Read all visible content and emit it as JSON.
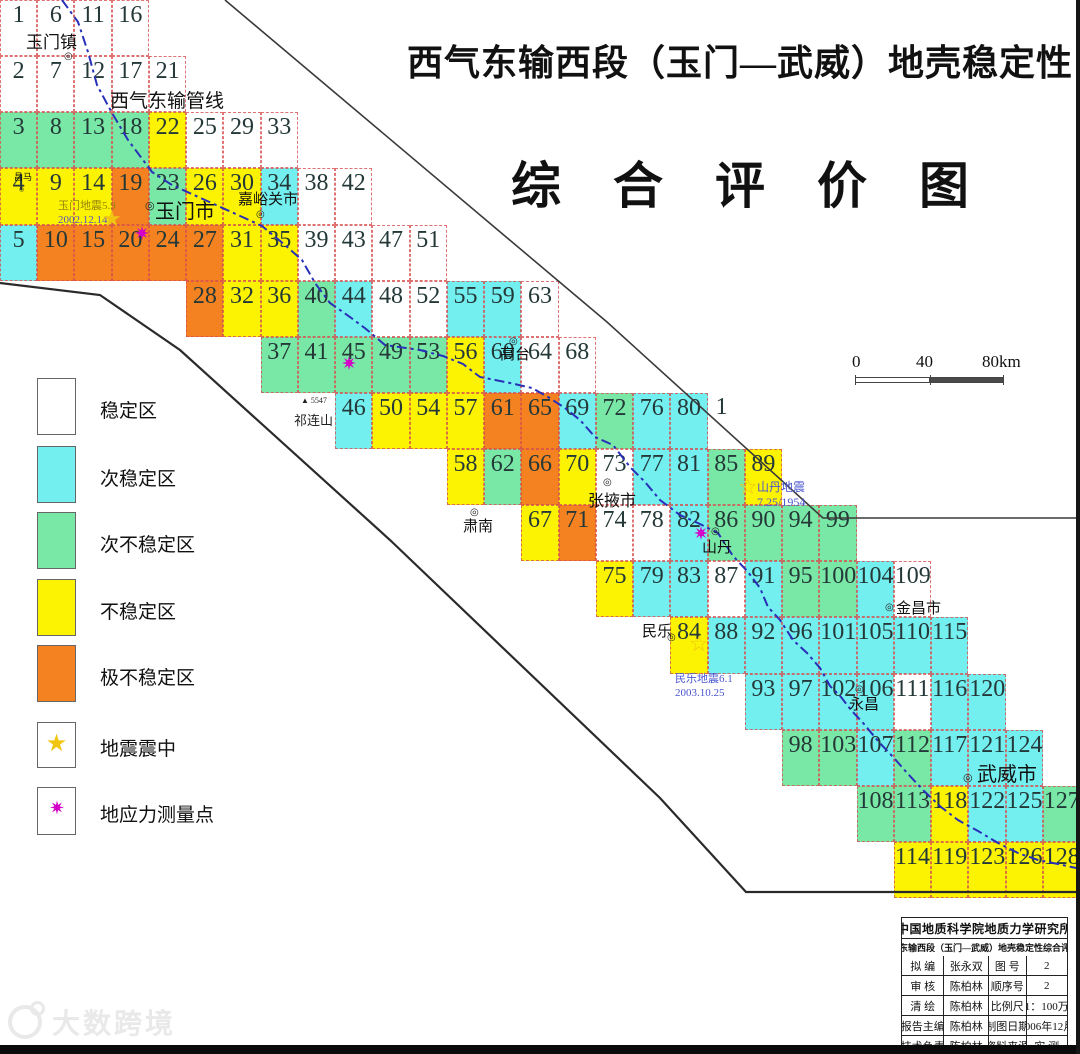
{
  "title": "西气东输西段（玉门—武威）地壳稳定性",
  "subtitle": "综合评价图",
  "map": {
    "colors": {
      "w": "#ffffff",
      "c": "#74eff0",
      "g": "#79e8a6",
      "y": "#fcf303",
      "o": "#f58220"
    },
    "pipeline_label": {
      "text": "西气东输管线",
      "x": 110,
      "y": 86,
      "fs": 19
    },
    "mountain": {
      "peak": "▲",
      "elev": "5547",
      "name": "祁连山",
      "px": 301,
      "py": 396,
      "nx": 294,
      "ny": 410
    },
    "cells": [
      [
        "1",
        0,
        0,
        "w"
      ],
      [
        "2",
        0,
        1,
        "w"
      ],
      [
        "3",
        0,
        2,
        "g"
      ],
      [
        "4",
        0,
        3,
        "y"
      ],
      [
        "5",
        0,
        4,
        "c"
      ],
      [
        "6",
        1,
        0,
        "w"
      ],
      [
        "7",
        1,
        1,
        "w"
      ],
      [
        "8",
        1,
        2,
        "g"
      ],
      [
        "9",
        1,
        3,
        "y"
      ],
      [
        "10",
        1,
        4,
        "o"
      ],
      [
        "11",
        2,
        0,
        "w"
      ],
      [
        "12",
        2,
        1,
        "w"
      ],
      [
        "13",
        2,
        2,
        "g"
      ],
      [
        "14",
        2,
        3,
        "y"
      ],
      [
        "15",
        2,
        4,
        "o"
      ],
      [
        "16",
        3,
        0,
        "w"
      ],
      [
        "17",
        3,
        1,
        "w"
      ],
      [
        "18",
        3,
        2,
        "g"
      ],
      [
        "19",
        3,
        3,
        "o"
      ],
      [
        "20",
        3,
        4,
        "o"
      ],
      [
        "21",
        4,
        1,
        "w"
      ],
      [
        "22",
        4,
        2,
        "y"
      ],
      [
        "23",
        4,
        3,
        "g"
      ],
      [
        "24",
        4,
        4,
        "o"
      ],
      [
        "25",
        5,
        2,
        "w"
      ],
      [
        "26",
        5,
        3,
        "y"
      ],
      [
        "27",
        5,
        4,
        "o"
      ],
      [
        "28",
        5,
        5,
        "o"
      ],
      [
        "29",
        6,
        2,
        "w"
      ],
      [
        "30",
        6,
        3,
        "y"
      ],
      [
        "31",
        6,
        4,
        "y"
      ],
      [
        "32",
        6,
        5,
        "y"
      ],
      [
        "33",
        7,
        2,
        "w"
      ],
      [
        "34",
        7,
        3,
        "c"
      ],
      [
        "35",
        7,
        4,
        "y"
      ],
      [
        "36",
        7,
        5,
        "y"
      ],
      [
        "37",
        7,
        6,
        "g"
      ],
      [
        "38",
        8,
        3,
        "w"
      ],
      [
        "39",
        8,
        4,
        "w"
      ],
      [
        "40",
        8,
        5,
        "g"
      ],
      [
        "41",
        8,
        6,
        "g"
      ],
      [
        "42",
        9,
        3,
        "w"
      ],
      [
        "43",
        9,
        4,
        "w"
      ],
      [
        "44",
        9,
        5,
        "c"
      ],
      [
        "45",
        9,
        6,
        "g"
      ],
      [
        "46",
        9,
        7,
        "c"
      ],
      [
        "47",
        10,
        4,
        "w"
      ],
      [
        "48",
        10,
        5,
        "w"
      ],
      [
        "49",
        10,
        6,
        "g"
      ],
      [
        "50",
        10,
        7,
        "y"
      ],
      [
        "51",
        11,
        4,
        "w"
      ],
      [
        "52",
        11,
        5,
        "w"
      ],
      [
        "53",
        11,
        6,
        "g"
      ],
      [
        "54",
        11,
        7,
        "y"
      ],
      [
        "55",
        12,
        5,
        "c"
      ],
      [
        "56",
        12,
        6,
        "y"
      ],
      [
        "57",
        12,
        7,
        "y"
      ],
      [
        "58",
        12,
        8,
        "y"
      ],
      [
        "59",
        13,
        5,
        "c"
      ],
      [
        "60",
        13,
        6,
        "c"
      ],
      [
        "61",
        13,
        7,
        "o"
      ],
      [
        "62",
        13,
        8,
        "g"
      ],
      [
        "63",
        14,
        5,
        "w"
      ],
      [
        "64",
        14,
        6,
        "w"
      ],
      [
        "65",
        14,
        7,
        "o"
      ],
      [
        "66",
        14,
        8,
        "o"
      ],
      [
        "67",
        14,
        9,
        "y"
      ],
      [
        "68",
        15,
        6,
        "w"
      ],
      [
        "69",
        15,
        7,
        "c"
      ],
      [
        "70",
        15,
        8,
        "y"
      ],
      [
        "71",
        15,
        9,
        "o"
      ],
      [
        "72",
        16,
        7,
        "g"
      ],
      [
        "73",
        16,
        8,
        "w"
      ],
      [
        "74",
        16,
        9,
        "w"
      ],
      [
        "75",
        16,
        10,
        "y"
      ],
      [
        "76",
        17,
        7,
        "c"
      ],
      [
        "77",
        17,
        8,
        "c"
      ],
      [
        "78",
        17,
        9,
        "w"
      ],
      [
        "79",
        17,
        10,
        "c"
      ],
      [
        "80",
        18,
        7,
        "c"
      ],
      [
        "81",
        18,
        8,
        "c"
      ],
      [
        "82",
        18,
        9,
        "c"
      ],
      [
        "83",
        18,
        10,
        "c"
      ],
      [
        "84",
        18,
        11,
        "y"
      ],
      [
        "1",
        19,
        7,
        "x"
      ],
      [
        "85",
        19,
        8,
        "g"
      ],
      [
        "86",
        19,
        9,
        "g"
      ],
      [
        "87",
        19,
        10,
        "w"
      ],
      [
        "88",
        19,
        11,
        "c"
      ],
      [
        "89",
        20,
        8,
        "y"
      ],
      [
        "90",
        20,
        9,
        "g"
      ],
      [
        "91",
        20,
        10,
        "c"
      ],
      [
        "92",
        20,
        11,
        "c"
      ],
      [
        "93",
        20,
        12,
        "c"
      ],
      [
        "94",
        21,
        9,
        "g"
      ],
      [
        "95",
        21,
        10,
        "g"
      ],
      [
        "96",
        21,
        11,
        "c"
      ],
      [
        "97",
        21,
        12,
        "c"
      ],
      [
        "98",
        21,
        13,
        "g"
      ],
      [
        "99",
        22,
        9,
        "g"
      ],
      [
        "100",
        22,
        10,
        "g"
      ],
      [
        "101",
        22,
        11,
        "c"
      ],
      [
        "102",
        22,
        12,
        "c"
      ],
      [
        "103",
        22,
        13,
        "g"
      ],
      [
        "104",
        23,
        10,
        "c"
      ],
      [
        "105",
        23,
        11,
        "c"
      ],
      [
        "106",
        23,
        12,
        "c"
      ],
      [
        "107",
        23,
        13,
        "c"
      ],
      [
        "108",
        23,
        14,
        "g"
      ],
      [
        "109",
        24,
        10,
        "w"
      ],
      [
        "110",
        24,
        11,
        "c"
      ],
      [
        "111",
        24,
        12,
        "w"
      ],
      [
        "112",
        24,
        13,
        "g"
      ],
      [
        "113",
        24,
        14,
        "g"
      ],
      [
        "114",
        24,
        15,
        "y"
      ],
      [
        "115",
        25,
        11,
        "c"
      ],
      [
        "116",
        25,
        12,
        "c"
      ],
      [
        "117",
        25,
        13,
        "c"
      ],
      [
        "118",
        25,
        14,
        "y"
      ],
      [
        "119",
        25,
        15,
        "y"
      ],
      [
        "120",
        26,
        12,
        "c"
      ],
      [
        "121",
        26,
        13,
        "c"
      ],
      [
        "122",
        26,
        14,
        "c"
      ],
      [
        "123",
        26,
        15,
        "y"
      ],
      [
        "124",
        27,
        13,
        "c"
      ],
      [
        "125",
        27,
        14,
        "c"
      ],
      [
        "126",
        27,
        15,
        "y"
      ],
      [
        "127",
        28,
        14,
        "g"
      ],
      [
        "128",
        28,
        15,
        "y"
      ]
    ],
    "cities": [
      {
        "name": "玉门镇",
        "x": 26,
        "y": 34,
        "fs": 17,
        "mx": 64,
        "my": 52,
        "ms": 10
      },
      {
        "name": "玉门市",
        "x": 155,
        "y": 202,
        "fs": 20,
        "mx": 145,
        "my": 201,
        "ms": 11
      },
      {
        "name": "嘉峪关市",
        "x": 238,
        "y": 193,
        "fs": 15,
        "mx": 256,
        "my": 210,
        "ms": 10
      },
      {
        "name": "高台",
        "x": 500,
        "y": 348,
        "fs": 15,
        "mx": 509,
        "my": 337,
        "ms": 10
      },
      {
        "name": "肃南",
        "x": 463,
        "y": 520,
        "fs": 15,
        "mx": 470,
        "my": 508,
        "ms": 10
      },
      {
        "name": "张掖市",
        "x": 588,
        "y": 494,
        "fs": 16,
        "mx": 603,
        "my": 478,
        "ms": 10
      },
      {
        "name": "山丹",
        "x": 702,
        "y": 541,
        "fs": 15,
        "mx": 711,
        "my": 527,
        "ms": 10
      },
      {
        "name": "民乐",
        "x": 642,
        "y": 625,
        "fs": 15,
        "mx": 667,
        "my": 633,
        "ms": 10
      },
      {
        "name": "金昌市",
        "x": 896,
        "y": 602,
        "fs": 15,
        "mx": 885,
        "my": 603,
        "ms": 10
      },
      {
        "name": "永昌",
        "x": 849,
        "y": 698,
        "fs": 15,
        "mx": 855,
        "my": 685,
        "ms": 10
      },
      {
        "name": "武威市",
        "x": 977,
        "y": 765,
        "fs": 20,
        "mx": 963,
        "my": 773,
        "ms": 11
      },
      {
        "name": "昌马",
        "x": 14,
        "y": 173,
        "fs": 9,
        "mx": 19,
        "my": 187,
        "ms": 6
      }
    ],
    "quakes": [
      {
        "x": 58,
        "y": 200,
        "fs": 11,
        "lines": [
          {
            "t": "玉门地震5.9",
            "c": "#97860e"
          },
          {
            "t": "2002.12.14",
            "c": "#5b50c0"
          }
        ]
      },
      {
        "x": 757,
        "y": 480,
        "fs": 12,
        "lines": [
          {
            "t": "山丹地震",
            "c": "#4b55d0"
          },
          {
            "t": "7.25/1954",
            "c": "#4b55d0"
          }
        ]
      },
      {
        "x": 675,
        "y": 673,
        "fs": 11,
        "lines": [
          {
            "t": "民乐地震6.1",
            "c": "#4b55d0"
          },
          {
            "t": "2003.10.25",
            "c": "#4b55d0"
          }
        ]
      }
    ],
    "stars": [
      {
        "x": 114,
        "y": 221,
        "filled": true
      },
      {
        "x": 750,
        "y": 489,
        "filled": false
      },
      {
        "x": 701,
        "y": 646,
        "filled": false
      }
    ],
    "flowers": [
      {
        "x": 142,
        "y": 233
      },
      {
        "x": 349,
        "y": 363
      },
      {
        "x": 701,
        "y": 533
      }
    ]
  },
  "legend": {
    "items": [
      {
        "label": "稳定区",
        "key": "w",
        "top": 378,
        "h": 57
      },
      {
        "label": "次稳定区",
        "key": "c",
        "top": 446,
        "h": 57
      },
      {
        "label": "次不稳定区",
        "key": "g",
        "top": 512,
        "h": 57
      },
      {
        "label": "不稳定区",
        "key": "y",
        "top": 579,
        "h": 57
      },
      {
        "label": "极不稳定区",
        "key": "o",
        "top": 645,
        "h": 57
      },
      {
        "label": "地震震中",
        "key": "star",
        "top": 722,
        "h": 46
      },
      {
        "label": "地应力测量点",
        "key": "flower",
        "top": 787,
        "h": 48
      }
    ]
  },
  "scalebar": {
    "labels": [
      "0",
      "40",
      "80km"
    ]
  },
  "infotable": {
    "header": "中国地质科学院地质力学研究所",
    "subheader": "西气东输西段（玉门—武威）地壳稳定性综合评价图",
    "rows": [
      [
        "拟  编",
        "张永双",
        "图  号",
        "2"
      ],
      [
        "审  核",
        "陈柏林",
        "顺序号",
        "2"
      ],
      [
        "清  绘",
        "陈柏林",
        "比例尺",
        "1：100万"
      ],
      [
        "报告主编",
        "陈柏林",
        "制图日期",
        "2006年12月"
      ],
      [
        "技术负责",
        "陈柏林",
        "资料来源",
        "实  测"
      ]
    ]
  },
  "watermark": {
    "text": "大数跨境"
  }
}
